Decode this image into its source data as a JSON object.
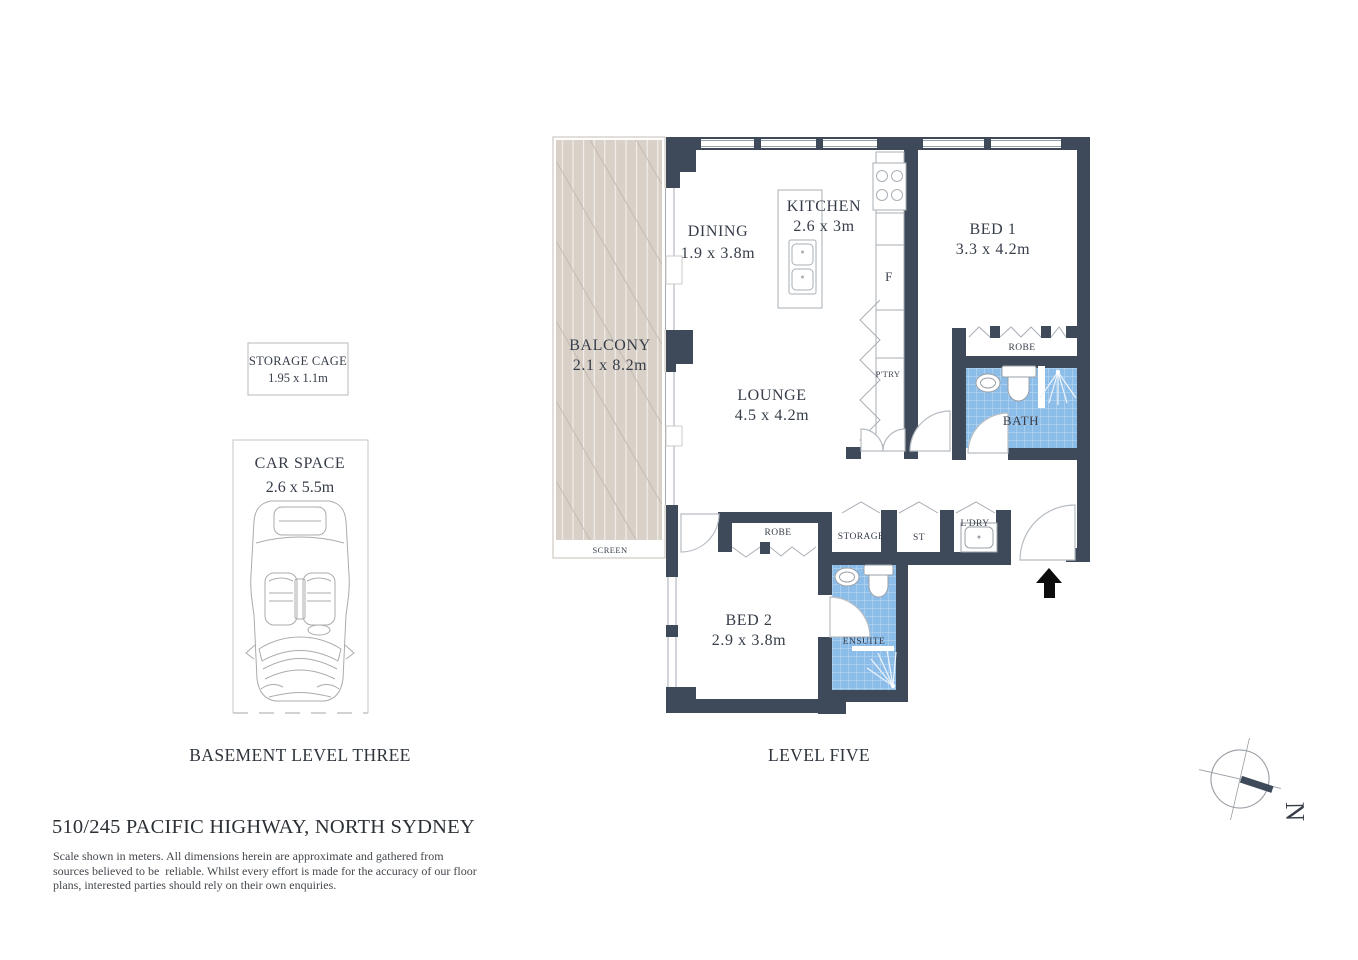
{
  "basement": {
    "caption": "BASEMENT LEVEL THREE",
    "storage_cage": {
      "title": "STORAGE CAGE",
      "dims": "1.95 x 1.1m"
    },
    "car_space": {
      "title": "CAR SPACE",
      "dims": "2.6 x 5.5m"
    }
  },
  "level5": {
    "caption": "LEVEL FIVE",
    "balcony": {
      "title": "BALCONY",
      "dims": "2.1 x 8.2m"
    },
    "dining": {
      "title": "DINING",
      "dims": "1.9 x 3.8m"
    },
    "kitchen": {
      "title": "KITCHEN",
      "dims": "2.6 x 3m"
    },
    "bed1": {
      "title": "BED 1",
      "dims": "3.3 x 4.2m"
    },
    "lounge": {
      "title": "LOUNGE",
      "dims": "4.5 x 4.2m"
    },
    "bed2": {
      "title": "BED 2",
      "dims": "2.9 x 3.8m"
    },
    "bath": "BATH",
    "ensuite": "ENSUITE",
    "robe_bed1": "ROBE",
    "robe_bed2": "ROBE",
    "storage": "STORAGE",
    "st": "ST",
    "laundry": "L'DRY",
    "pantry": "P'TRY",
    "fridge": "F",
    "screen": "SCREEN"
  },
  "compass": {
    "north": "N"
  },
  "footer": {
    "address": "510/245 PACIFIC HIGHWAY, NORTH SYDNEY",
    "disclaimer_lines": [
      "Scale shown in meters. All dimensions herein are approximate and gathered from",
      "sources believed to be  reliable. Whilst every effort is made for the accuracy of our floor",
      "plans, interested parties should rely on their own enquiries."
    ]
  },
  "colors": {
    "wall": "#3e4a59",
    "wet_area": "#8cbde9",
    "balcony_deck": "#d9d1c8"
  }
}
